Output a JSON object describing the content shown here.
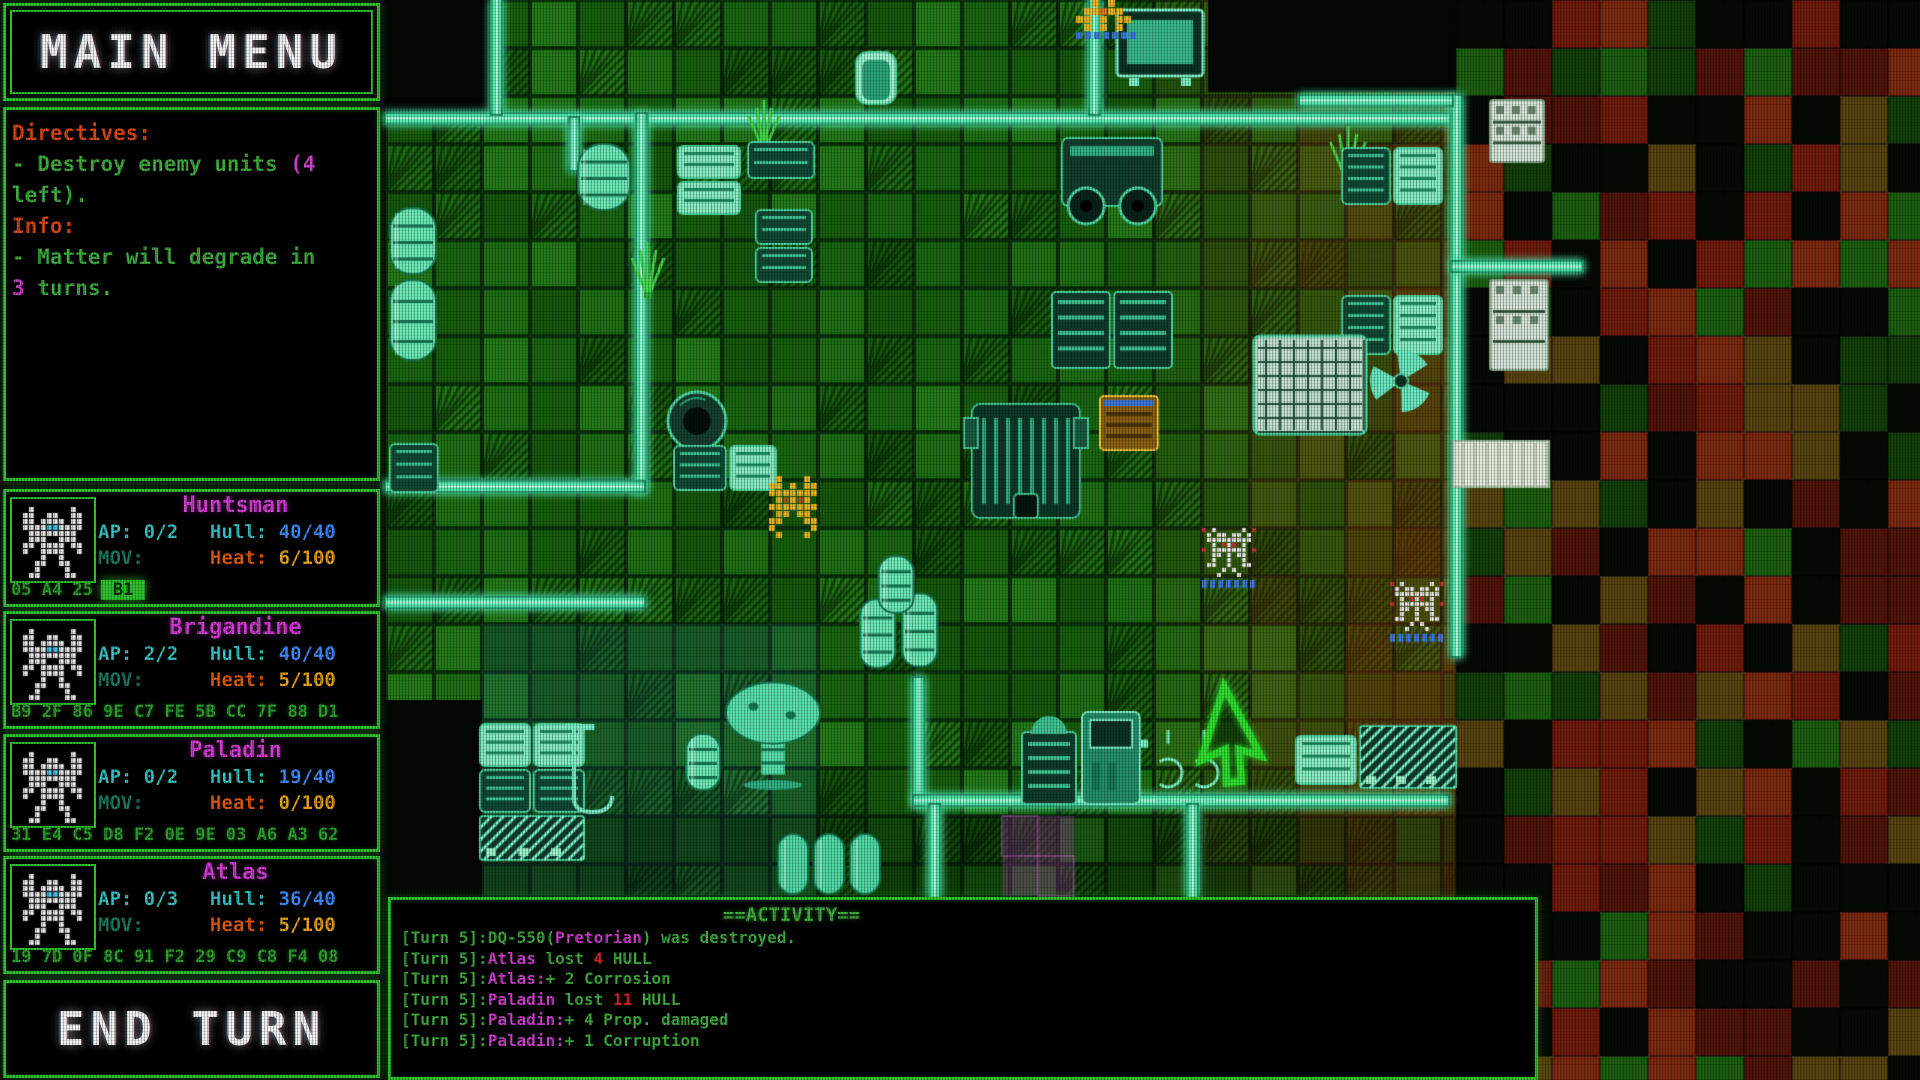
{
  "main_menu": {
    "label": "MAIN MENU"
  },
  "end_turn": {
    "label": "END TURN"
  },
  "directives_panel": {
    "lines": [
      [
        {
          "t": "Directives:",
          "c": "o"
        }
      ],
      [
        {
          "t": "- Destroy enemy units ",
          "c": "g"
        },
        {
          "t": "(4",
          "c": "m"
        }
      ],
      [
        {
          "t": "left).",
          "c": "g"
        }
      ],
      [
        {
          "t": "Info:",
          "c": "o"
        }
      ],
      [
        {
          "t": "- Matter will degrade in",
          "c": "g"
        }
      ],
      [
        {
          "t": "3",
          "c": "m"
        },
        {
          "t": " turns.",
          "c": "g"
        }
      ]
    ]
  },
  "units": [
    {
      "name": "Huntsman",
      "ap": "AP: 0/2",
      "hull_label": "Hull:",
      "hull": "40/40",
      "mov": "MOV:",
      "heat_label": "Heat:",
      "heat": "6/100",
      "hex": "05 A4 25",
      "hex_hl": "B1"
    },
    {
      "name": "Brigandine",
      "ap": "AP: 2/2",
      "hull_label": "Hull:",
      "hull": "40/40",
      "mov": "MOV:",
      "heat_label": "Heat:",
      "heat": "5/100",
      "hex": "B9 2F 86 9E C7 FE 5B CC 7F 88 D1",
      "hex_hl": ""
    },
    {
      "name": "Paladin",
      "ap": "AP: 0/2",
      "hull_label": "Hull:",
      "hull": "19/40",
      "mov": "MOV:",
      "heat_label": "Heat:",
      "heat": "0/100",
      "hex": "31 E4 C5 D8 F2 0E 9E 03 A6 A3 62",
      "hex_hl": ""
    },
    {
      "name": "Atlas",
      "ap": "AP: 0/3",
      "hull_label": "Hull:",
      "hull": "36/40",
      "mov": "MOV:",
      "heat_label": "Heat:",
      "heat": "5/100",
      "hex": "19 7D 0F 8C 91 F2 29 C9 C8 F4 08",
      "hex_hl": ""
    }
  ],
  "activity": {
    "header": "==ACTIVITY==",
    "lines": [
      [
        {
          "t": "[Turn 5]:DQ-550(",
          "c": "g"
        },
        {
          "t": "Pretorian",
          "c": "m"
        },
        {
          "t": ") was destroyed.",
          "c": "g"
        }
      ],
      [
        {
          "t": "[Turn 5]:",
          "c": "g"
        },
        {
          "t": "Atlas",
          "c": "m"
        },
        {
          "t": " lost ",
          "c": "g"
        },
        {
          "t": "4",
          "c": "r"
        },
        {
          "t": " HULL",
          "c": "g"
        }
      ],
      [
        {
          "t": "[Turn 5]:",
          "c": "g"
        },
        {
          "t": "Atlas:",
          "c": "m"
        },
        {
          "t": "+ 2 Corrosion",
          "c": "g"
        }
      ],
      [
        {
          "t": "[Turn 5]:",
          "c": "g"
        },
        {
          "t": "Paladin",
          "c": "m"
        },
        {
          "t": " lost ",
          "c": "g"
        },
        {
          "t": "11",
          "c": "r"
        },
        {
          "t": " HULL",
          "c": "g"
        }
      ],
      [
        {
          "t": "[Turn 5]:",
          "c": "g"
        },
        {
          "t": "Paladin:",
          "c": "m"
        },
        {
          "t": "+ 4 Prop. damaged",
          "c": "g"
        }
      ],
      [
        {
          "t": "[Turn 5]:",
          "c": "g"
        },
        {
          "t": "Paladin:",
          "c": "m"
        },
        {
          "t": "+ 1 Corruption",
          "c": "g"
        }
      ]
    ]
  },
  "colors": {
    "border": "#2ec22e",
    "green": "#3fae3f",
    "magenta": "#d23fd2",
    "red": "#e02626",
    "orange": "#d84818",
    "cyan": "#38c4c4",
    "blue": "#3f8cff",
    "heat-label": "#e05a10",
    "heat-val": "#e8a51c",
    "mov": "#1d7a60",
    "hex": "#2f9f2f"
  },
  "map": {
    "tile": 48,
    "palette": {
      "bg": "#040604",
      "floor": [
        "#16590d",
        "#1a6611",
        "#1f7015",
        "#247a19",
        "#185f0e"
      ],
      "grid": "#08320a",
      "mosaic": [
        "#060904",
        "#060904",
        "#060903",
        "#4f1309",
        "#701c0c",
        "#7c2a10",
        "#584410",
        "#123f0a",
        "#1d5f10"
      ],
      "wall_core": "#54e8ae",
      "wall_edge": "#157a52",
      "wall_hi": "#c2ffe4",
      "tint_red": "130,45,8",
      "tint_blue": "30,90,140",
      "prop_line": "#4fd8a4",
      "prop_bright": "#7df0c8",
      "prop_fill": "#0f3d2c",
      "prop_light": "#9df4d0",
      "gold": "#e8b626",
      "gold_dark": "#a05c10",
      "gold_mid": "#e07818",
      "enemy_white": "#ececec",
      "enemy_red": "#d03030",
      "unit_base_blue": "#3a7ae0",
      "cursor": "#2fe02f",
      "purple": "180,60,180",
      "white_tile": "#e4ecdc"
    },
    "floor_rects": [
      {
        "x": 386,
        "y": 0,
        "w": 1070,
        "h": 897
      }
    ],
    "voids": [
      {
        "x": 386,
        "y": 0,
        "w": 106,
        "h": 114
      },
      {
        "x": 1208,
        "y": 0,
        "w": 248,
        "h": 92
      },
      {
        "x": 386,
        "y": 700,
        "w": 96,
        "h": 197
      }
    ],
    "mosaic_rect": {
      "x": 1456,
      "y": 0,
      "w": 464,
      "h": 1080
    },
    "red_tint": {
      "x0": 1100,
      "x1": 1456
    },
    "blue_tint": {
      "x": 470,
      "y": 620,
      "w": 320,
      "h": 277
    },
    "dark_row_y": 816,
    "walls": [
      {
        "x": 386,
        "y": 114,
        "w": 1066,
        "h": 9
      },
      {
        "x": 492,
        "y": 0,
        "w": 9,
        "h": 114
      },
      {
        "x": 1090,
        "y": 0,
        "w": 9,
        "h": 114
      },
      {
        "x": 637,
        "y": 114,
        "w": 9,
        "h": 377
      },
      {
        "x": 386,
        "y": 482,
        "w": 258,
        "h": 9
      },
      {
        "x": 386,
        "y": 598,
        "w": 258,
        "h": 9
      },
      {
        "x": 570,
        "y": 118,
        "w": 8,
        "h": 52
      },
      {
        "x": 914,
        "y": 678,
        "w": 9,
        "h": 127
      },
      {
        "x": 914,
        "y": 796,
        "w": 534,
        "h": 9
      },
      {
        "x": 930,
        "y": 805,
        "w": 9,
        "h": 92
      },
      {
        "x": 1188,
        "y": 805,
        "w": 9,
        "h": 92
      },
      {
        "x": 1452,
        "y": 96,
        "w": 9,
        "h": 560
      },
      {
        "x": 1300,
        "y": 96,
        "w": 152,
        "h": 9
      },
      {
        "x": 1452,
        "y": 262,
        "w": 130,
        "h": 9
      }
    ],
    "props": [
      {
        "type": "monitor",
        "x": 1117,
        "y": 10,
        "w": 86,
        "h": 78
      },
      {
        "type": "door",
        "x": 856,
        "y": 52,
        "w": 40,
        "h": 52
      },
      {
        "type": "plant",
        "x": 745,
        "y": 100,
        "w": 38,
        "h": 52
      },
      {
        "type": "plant",
        "x": 628,
        "y": 242,
        "w": 40,
        "h": 56
      },
      {
        "type": "plant",
        "x": 1326,
        "y": 126,
        "w": 44,
        "h": 58
      },
      {
        "type": "barrel",
        "x": 578,
        "y": 144,
        "w": 52,
        "h": 66
      },
      {
        "type": "crate",
        "x": 678,
        "y": 146,
        "w": 62,
        "h": 32
      },
      {
        "type": "crate",
        "x": 678,
        "y": 182,
        "w": 62,
        "h": 32
      },
      {
        "type": "crate",
        "x": 748,
        "y": 142,
        "w": 66,
        "h": 36
      },
      {
        "type": "crate",
        "x": 756,
        "y": 210,
        "w": 56,
        "h": 34
      },
      {
        "type": "crate",
        "x": 756,
        "y": 248,
        "w": 56,
        "h": 34
      },
      {
        "type": "barrel",
        "x": 390,
        "y": 208,
        "w": 46,
        "h": 66
      },
      {
        "type": "barrel",
        "x": 390,
        "y": 280,
        "w": 46,
        "h": 80
      },
      {
        "type": "crate",
        "x": 390,
        "y": 444,
        "w": 48,
        "h": 48
      },
      {
        "type": "wheelmachine",
        "x": 1056,
        "y": 138,
        "w": 112,
        "h": 90
      },
      {
        "type": "crate",
        "x": 1342,
        "y": 148,
        "w": 48,
        "h": 56
      },
      {
        "type": "crate",
        "x": 1394,
        "y": 148,
        "w": 48,
        "h": 56
      },
      {
        "type": "shelf",
        "x": 1490,
        "y": 100,
        "w": 54,
        "h": 62
      },
      {
        "type": "machine",
        "x": 1052,
        "y": 292,
        "w": 58,
        "h": 76
      },
      {
        "type": "machine",
        "x": 1114,
        "y": 292,
        "w": 58,
        "h": 76
      },
      {
        "type": "crate",
        "x": 1342,
        "y": 296,
        "w": 48,
        "h": 58
      },
      {
        "type": "crate",
        "x": 1394,
        "y": 296,
        "w": 48,
        "h": 58
      },
      {
        "type": "shelf",
        "x": 1490,
        "y": 280,
        "w": 58,
        "h": 90
      },
      {
        "type": "bigmachine",
        "x": 1254,
        "y": 336,
        "w": 112,
        "h": 98
      },
      {
        "type": "fan",
        "x": 1370,
        "y": 350,
        "w": 62,
        "h": 62
      },
      {
        "type": "tire",
        "x": 666,
        "y": 390,
        "w": 62,
        "h": 62
      },
      {
        "type": "crate",
        "x": 674,
        "y": 446,
        "w": 52,
        "h": 44
      },
      {
        "type": "crate",
        "x": 730,
        "y": 446,
        "w": 46,
        "h": 44
      },
      {
        "type": "goldmachine",
        "x": 1100,
        "y": 396,
        "w": 58,
        "h": 54
      },
      {
        "type": "mechprop",
        "x": 964,
        "y": 404,
        "w": 124,
        "h": 124
      },
      {
        "type": "barrelstack",
        "x": 860,
        "y": 556,
        "w": 84,
        "h": 114
      },
      {
        "type": "whitetile",
        "x": 1452,
        "y": 440,
        "w": 98,
        "h": 48
      },
      {
        "type": "mushroom",
        "x": 724,
        "y": 680,
        "w": 98,
        "h": 110
      },
      {
        "type": "barrel",
        "x": 686,
        "y": 734,
        "w": 34,
        "h": 56
      },
      {
        "type": "crate",
        "x": 480,
        "y": 724,
        "w": 50,
        "h": 42
      },
      {
        "type": "crate",
        "x": 534,
        "y": 724,
        "w": 50,
        "h": 42
      },
      {
        "type": "crate",
        "x": 480,
        "y": 770,
        "w": 50,
        "h": 42
      },
      {
        "type": "crate",
        "x": 534,
        "y": 770,
        "w": 50,
        "h": 42
      },
      {
        "type": "hatch",
        "x": 480,
        "y": 816,
        "w": 104,
        "h": 44
      },
      {
        "type": "hook",
        "x": 566,
        "y": 724,
        "w": 52,
        "h": 92
      },
      {
        "type": "grillmachine",
        "x": 1022,
        "y": 724,
        "w": 54,
        "h": 80
      },
      {
        "type": "pump",
        "x": 1082,
        "y": 712,
        "w": 66,
        "h": 92
      },
      {
        "type": "claw",
        "x": 1152,
        "y": 730,
        "w": 32,
        "h": 74
      },
      {
        "type": "claw",
        "x": 1188,
        "y": 730,
        "w": 32,
        "h": 74
      },
      {
        "type": "crate",
        "x": 1296,
        "y": 736,
        "w": 60,
        "h": 48
      },
      {
        "type": "hatch",
        "x": 1360,
        "y": 726,
        "w": 96,
        "h": 62
      },
      {
        "type": "capsule",
        "x": 778,
        "y": 834,
        "w": 30,
        "h": 60
      },
      {
        "type": "capsule",
        "x": 814,
        "y": 834,
        "w": 30,
        "h": 60
      },
      {
        "type": "capsule",
        "x": 850,
        "y": 834,
        "w": 30,
        "h": 60
      },
      {
        "type": "purple",
        "x": 1002,
        "y": 816,
        "w": 72,
        "h": 80
      },
      {
        "type": "orangeunit",
        "x": 1076,
        "y": 0,
        "w": 64,
        "h": 40
      }
    ],
    "map_units": [
      {
        "side": "enemy",
        "x": 1202,
        "y": 528,
        "w": 55,
        "h": 62
      },
      {
        "side": "enemy",
        "x": 1390,
        "y": 582,
        "w": 55,
        "h": 60
      },
      {
        "side": "player",
        "x": 762,
        "y": 476,
        "w": 64,
        "h": 70
      }
    ],
    "cursor": {
      "x": 1224,
      "y": 686
    }
  }
}
